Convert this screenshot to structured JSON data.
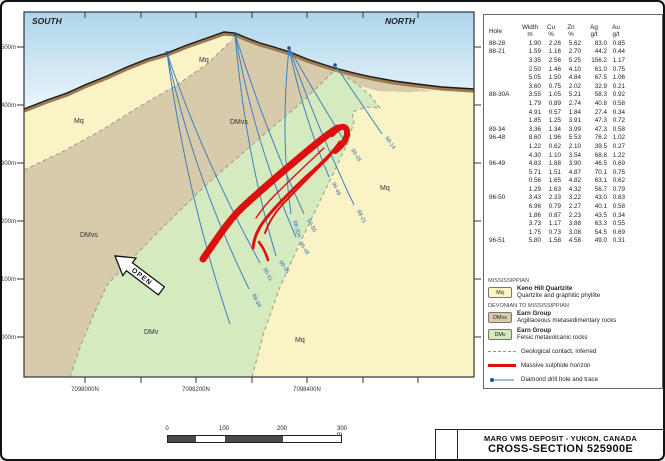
{
  "section": {
    "south": "SOUTH",
    "north": "NORTH",
    "open": "OPEN",
    "labels": {
      "mq_upper_left": "Mq",
      "mq_peak": "Mq",
      "mq_right": "Mq",
      "mq_bottom": "Mq",
      "dmvs_top": "DMvs",
      "dmvs_left": "DMvs",
      "dmv": "DMv"
    },
    "elevations": [
      "1500m",
      "1400m",
      "1300m",
      "1200m",
      "1100m",
      "1000m"
    ],
    "northings": [
      "7098000N",
      "7098200N",
      "7098400N"
    ]
  },
  "holes": [
    {
      "label": "88-14"
    },
    {
      "label": "88-28"
    },
    {
      "label": "96-49"
    },
    {
      "label": "88-21"
    },
    {
      "label": "96-50"
    },
    {
      "label": "88-30A"
    },
    {
      "label": "96-48"
    },
    {
      "label": "89-35"
    },
    {
      "label": "96-51"
    },
    {
      "label": "89-34"
    }
  ],
  "assay_table": {
    "col1": "Hole",
    "headers": [
      [
        "Width",
        "m"
      ],
      [
        "Cu",
        "%"
      ],
      [
        "Zn",
        "%"
      ],
      [
        "Ag",
        "g/t"
      ],
      [
        "Au",
        "g/t"
      ]
    ],
    "rows": [
      [
        "88-28",
        "1.90",
        "2.26",
        "5.62",
        "83.0",
        "0.85"
      ],
      [
        "88-21",
        "1.59",
        "1.16",
        "2.70",
        "44.2",
        "0.44"
      ],
      [
        "",
        "3.35",
        "2.56",
        "5.25",
        "156.2",
        "1.17"
      ],
      [
        "",
        "2.50",
        "1.46",
        "4.10",
        "61.0",
        "0.75"
      ],
      [
        "",
        "5.05",
        "1.50",
        "4.84",
        "67.5",
        "1.06"
      ],
      [
        "",
        "3.60",
        "0.75",
        "2.02",
        "32.9",
        "0.21"
      ],
      [
        "88-30A",
        "3.55",
        "1.05",
        "5.21",
        "58.3",
        "0.92"
      ],
      [
        "",
        "1.79",
        "0.89",
        "2.74",
        "40.8",
        "0.58"
      ],
      [
        "",
        "4.91",
        "0.57",
        "1.84",
        "27.4",
        "0.34"
      ],
      [
        "",
        "1.85",
        "1.25",
        "3.91",
        "47.3",
        "0.72"
      ],
      [
        "89-34",
        "3.36",
        "1.34",
        "3.99",
        "47.3",
        "0.58"
      ],
      [
        "96-48",
        "8.60",
        "1.96",
        "5.53",
        "76.2",
        "1.02"
      ],
      [
        "",
        "1.22",
        "0.62",
        "2.10",
        "39.5",
        "0.27"
      ],
      [
        "",
        "4.30",
        "1.10",
        "3.54",
        "68.8",
        "1.22"
      ],
      [
        "96-49",
        "4.83",
        "1.88",
        "3.90",
        "46.5",
        "0.69"
      ],
      [
        "",
        "5.71",
        "1.51",
        "4.87",
        "70.1",
        "0.75"
      ],
      [
        "",
        "0.56",
        "1.65",
        "4.82",
        "63.1",
        "0.62"
      ],
      [
        "",
        "1.29",
        "1.63",
        "4.32",
        "56.7",
        "0.79"
      ],
      [
        "96-50",
        "3.43",
        "2.33",
        "3.22",
        "43.0",
        "0.83"
      ],
      [
        "",
        "6.96",
        "0.79",
        "2.27",
        "40.1",
        "0.58"
      ],
      [
        "",
        "1.86",
        "0.87",
        "2.23",
        "43.5",
        "0.34"
      ],
      [
        "",
        "3.73",
        "1.17",
        "3.88",
        "63.3",
        "0.55"
      ],
      [
        "",
        "1.75",
        "0.73",
        "3.08",
        "54.5",
        "0.69"
      ],
      [
        "96-51",
        "5.80",
        "1.58",
        "4.58",
        "49.0",
        "0.31"
      ]
    ]
  },
  "legend": {
    "era1": "MISSISSIPPIAN",
    "era2": "DEVONIAN TO MISSISSIPPIAN",
    "units": [
      {
        "code": "Mq",
        "name": "Keno Hill Quartzite",
        "desc": "Quartzite and graphitic phyllite",
        "color": "#faf3c6"
      },
      {
        "code": "DMvs",
        "name": "Earn Group",
        "desc": "Argillaceous metasedimentary rocks",
        "color": "#d8cbab"
      },
      {
        "code": "DMv",
        "name": "Earn Group",
        "desc": "Felsic metavolcanic rocks",
        "color": "#d6eabf"
      }
    ],
    "lines": [
      {
        "label": "Geological contact, inferred"
      },
      {
        "label": "Massive sulphide horizon"
      },
      {
        "label": "Diamond drill hole and trace"
      }
    ]
  },
  "scale_bar": {
    "labels": [
      "0",
      "100",
      "200",
      "300 m"
    ]
  },
  "title_block": {
    "line1": "MARG VMS DEPOSIT - YUKON, CANADA",
    "line2": "CROSS-SECTION 525900E"
  },
  "colors": {
    "sky": "#b5d9ee",
    "mq": "#faf3c6",
    "dmvs": "#d8cbab",
    "dmv": "#d6eabf",
    "soil": "#9c7a50",
    "sulphide": "#dd1010",
    "drill": "#3f7fbf",
    "contact": "#9a9a8a"
  }
}
